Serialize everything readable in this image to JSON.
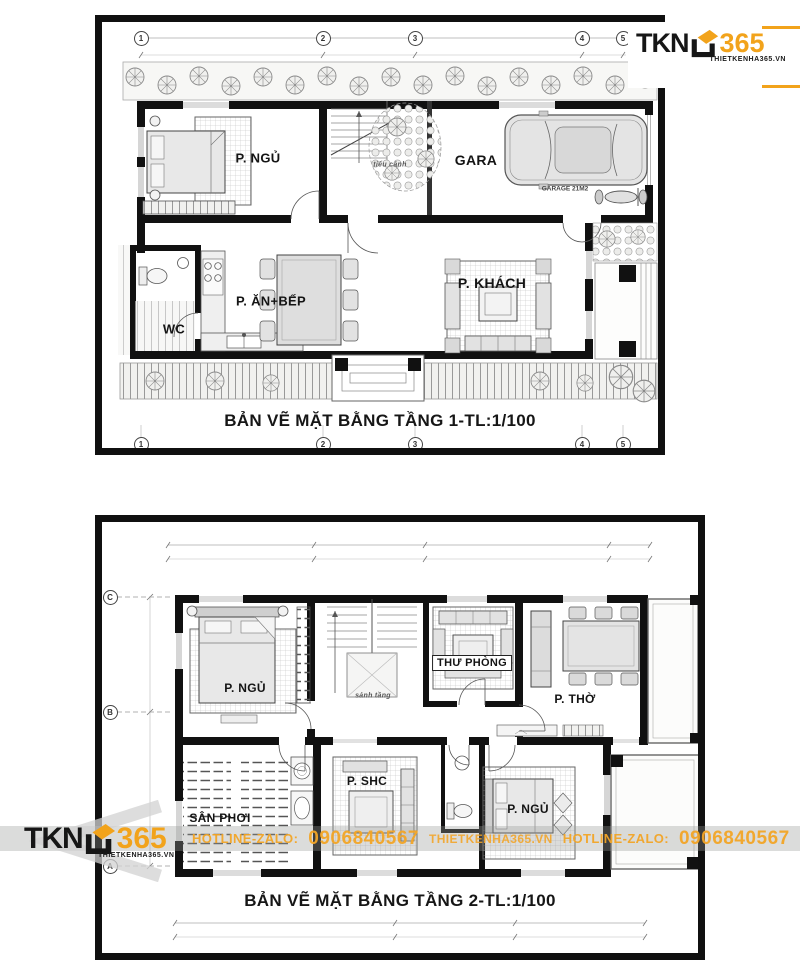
{
  "colors": {
    "accent_orange": "#F2A31B",
    "ink": "#161616"
  },
  "logo": {
    "name_prefix": "TKN",
    "name_number": "365",
    "website": "THIETKENHA365.VN"
  },
  "watermark": {
    "hotline_label": "HOTLINE-ZALO:",
    "phone": "0906840567",
    "website": "THIETKENHA365.VN"
  },
  "floor1": {
    "title": "BẢN VẼ MẶT BẰNG TẦNG 1-TL:1/100",
    "grid_cols": [
      "1",
      "2",
      "3",
      "4",
      "5"
    ],
    "rooms": {
      "bedroom": "P. NGỦ",
      "garage": "GARA",
      "garage_note": "GARAGE 21M2",
      "garden": "tiểu cảnh",
      "kitchen_dining": "P. ĂN+BẾP",
      "wc": "WC",
      "living": "P. KHÁCH"
    }
  },
  "floor2": {
    "title": "BẢN VẼ MẶT BẰNG TẦNG 2-TL:1/100",
    "grid_rows": [
      "C",
      "B",
      "A"
    ],
    "rooms": {
      "bedroom1": "P. NGỦ",
      "lobby": "sảnh tầng",
      "study": "THƯ PHÒNG",
      "worship": "P. THỜ",
      "laundry": "SÂN PHƠI",
      "family": "P. SHC",
      "bedroom2": "P. NGỦ"
    }
  }
}
